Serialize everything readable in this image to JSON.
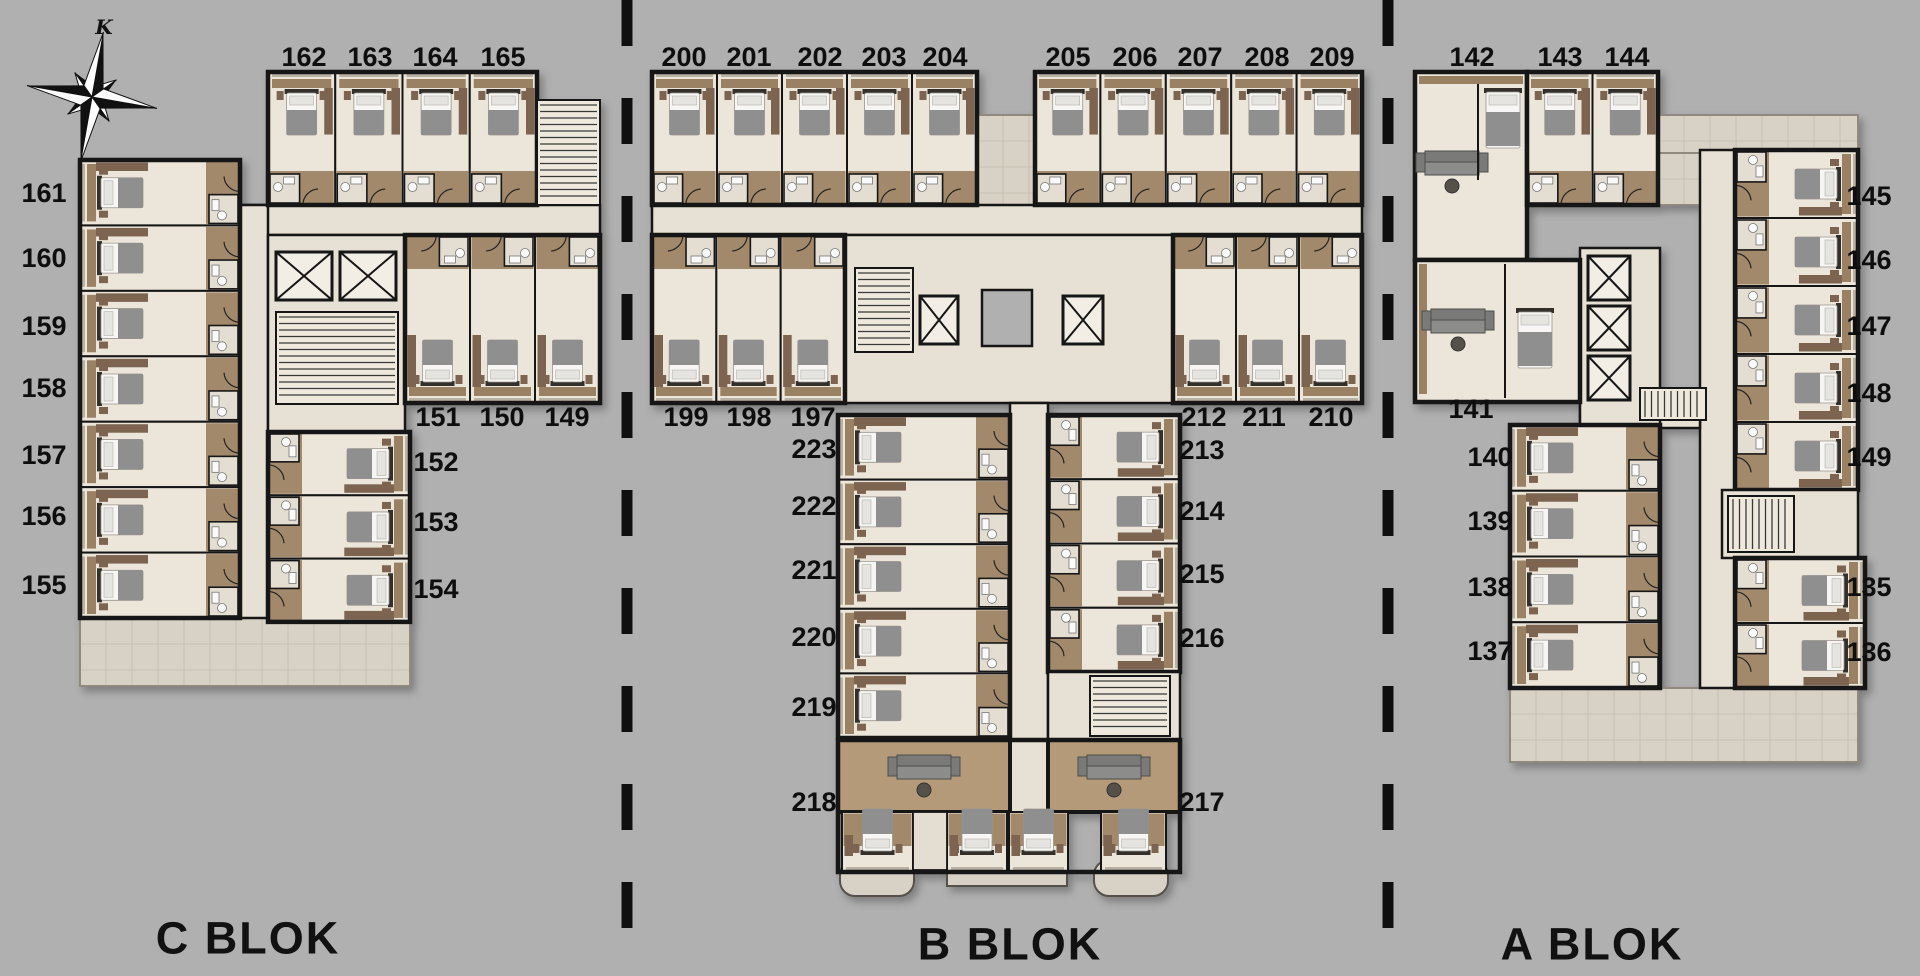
{
  "colors": {
    "background": "#b0b0b0",
    "wall": "#161616",
    "room_floor": "#ece5da",
    "corridor": "#e7e0d4",
    "wood": "#9b8163",
    "wardrobe": "#7c6450",
    "terrace": "#d8d1c5",
    "bed_blanket": "#8f8f8f",
    "bed_mattress": "#f7f6f4"
  },
  "compass": {
    "label": "K"
  },
  "blocks": [
    {
      "name": "C BLOK",
      "label_pos": {
        "x": 248,
        "y": 938
      },
      "rooms": [
        {
          "n": "162",
          "x": 304,
          "y": 57
        },
        {
          "n": "163",
          "x": 370,
          "y": 57
        },
        {
          "n": "164",
          "x": 435,
          "y": 57
        },
        {
          "n": "165",
          "x": 503,
          "y": 57
        },
        {
          "n": "161",
          "x": 44,
          "y": 193
        },
        {
          "n": "160",
          "x": 44,
          "y": 258
        },
        {
          "n": "159",
          "x": 44,
          "y": 326
        },
        {
          "n": "158",
          "x": 44,
          "y": 388
        },
        {
          "n": "157",
          "x": 44,
          "y": 455
        },
        {
          "n": "156",
          "x": 44,
          "y": 516
        },
        {
          "n": "155",
          "x": 44,
          "y": 585
        },
        {
          "n": "151",
          "x": 438,
          "y": 417
        },
        {
          "n": "150",
          "x": 502,
          "y": 417
        },
        {
          "n": "149",
          "x": 567,
          "y": 417
        },
        {
          "n": "152",
          "x": 436,
          "y": 462
        },
        {
          "n": "153",
          "x": 436,
          "y": 522
        },
        {
          "n": "154",
          "x": 436,
          "y": 589
        }
      ]
    },
    {
      "name": "B BLOK",
      "label_pos": {
        "x": 1010,
        "y": 944
      },
      "rooms": [
        {
          "n": "200",
          "x": 684,
          "y": 57
        },
        {
          "n": "201",
          "x": 749,
          "y": 57
        },
        {
          "n": "202",
          "x": 820,
          "y": 57
        },
        {
          "n": "203",
          "x": 884,
          "y": 57
        },
        {
          "n": "204",
          "x": 945,
          "y": 57
        },
        {
          "n": "205",
          "x": 1068,
          "y": 57
        },
        {
          "n": "206",
          "x": 1135,
          "y": 57
        },
        {
          "n": "207",
          "x": 1200,
          "y": 57
        },
        {
          "n": "208",
          "x": 1267,
          "y": 57
        },
        {
          "n": "209",
          "x": 1332,
          "y": 57
        },
        {
          "n": "199",
          "x": 686,
          "y": 417
        },
        {
          "n": "198",
          "x": 749,
          "y": 417
        },
        {
          "n": "197",
          "x": 813,
          "y": 417
        },
        {
          "n": "212",
          "x": 1204,
          "y": 417
        },
        {
          "n": "211",
          "x": 1264,
          "y": 417
        },
        {
          "n": "210",
          "x": 1331,
          "y": 417
        },
        {
          "n": "223",
          "x": 814,
          "y": 449
        },
        {
          "n": "222",
          "x": 814,
          "y": 506
        },
        {
          "n": "221",
          "x": 814,
          "y": 570
        },
        {
          "n": "220",
          "x": 814,
          "y": 637
        },
        {
          "n": "219",
          "x": 814,
          "y": 707
        },
        {
          "n": "218",
          "x": 814,
          "y": 802
        },
        {
          "n": "213",
          "x": 1202,
          "y": 450
        },
        {
          "n": "214",
          "x": 1202,
          "y": 511
        },
        {
          "n": "215",
          "x": 1202,
          "y": 574
        },
        {
          "n": "216",
          "x": 1202,
          "y": 638
        },
        {
          "n": "217",
          "x": 1202,
          "y": 802
        }
      ]
    },
    {
      "name": "A BLOK",
      "label_pos": {
        "x": 1592,
        "y": 944
      },
      "rooms": [
        {
          "n": "142",
          "x": 1472,
          "y": 57
        },
        {
          "n": "143",
          "x": 1560,
          "y": 57
        },
        {
          "n": "144",
          "x": 1627,
          "y": 57
        },
        {
          "n": "145",
          "x": 1869,
          "y": 196
        },
        {
          "n": "146",
          "x": 1869,
          "y": 260
        },
        {
          "n": "147",
          "x": 1869,
          "y": 326
        },
        {
          "n": "148",
          "x": 1869,
          "y": 393
        },
        {
          "n": "149",
          "x": 1869,
          "y": 457
        },
        {
          "n": "135",
          "x": 1869,
          "y": 587
        },
        {
          "n": "136",
          "x": 1869,
          "y": 652
        },
        {
          "n": "141",
          "x": 1471,
          "y": 409
        },
        {
          "n": "140",
          "x": 1490,
          "y": 457
        },
        {
          "n": "139",
          "x": 1490,
          "y": 521
        },
        {
          "n": "138",
          "x": 1490,
          "y": 587
        },
        {
          "n": "137",
          "x": 1490,
          "y": 651
        }
      ]
    }
  ]
}
